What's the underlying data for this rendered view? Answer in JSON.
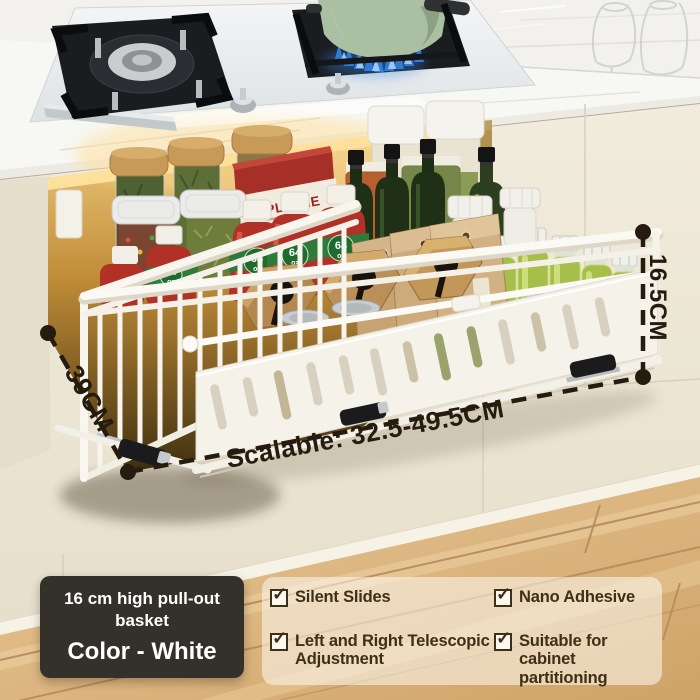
{
  "annotations": {
    "height": "16.5CM",
    "depth": "39CM",
    "width": "Scalable: 32.5-49.5CM"
  },
  "info_box": {
    "title": "16 cm high pull-out basket",
    "color_line": "Color - White"
  },
  "features": {
    "check_glyph": "✓",
    "items": [
      {
        "label": "Silent Slides"
      },
      {
        "label": "Nano Adhesive"
      },
      {
        "label": "Left and Right Telescopic Adjustment"
      },
      {
        "label": "Suitable for cabinet partitioning"
      }
    ]
  },
  "products": {
    "box_title": "APPLE PIE",
    "bottle_size": "64",
    "bottle_unit": "oz"
  },
  "colors": {
    "annotation": "#261b0f",
    "text_brown": "#3e2f17",
    "info_box_bg": "#34302a",
    "panel_tint": "#fdfaf3",
    "cream": "#efe8d8",
    "gold": "#e3b95f",
    "wood_floor": "#dfb884",
    "wood_board": "#b3874e",
    "ketchup_red": "#b23127",
    "band_green": "#2e7a3b",
    "pot_green": "#abbfa3",
    "flame_blue": "#2f7bd9",
    "juice_green": "#a6bf4a",
    "oil_dark": "#203016",
    "kraft_tan": "#c7a374",
    "box_red": "#a63028"
  }
}
